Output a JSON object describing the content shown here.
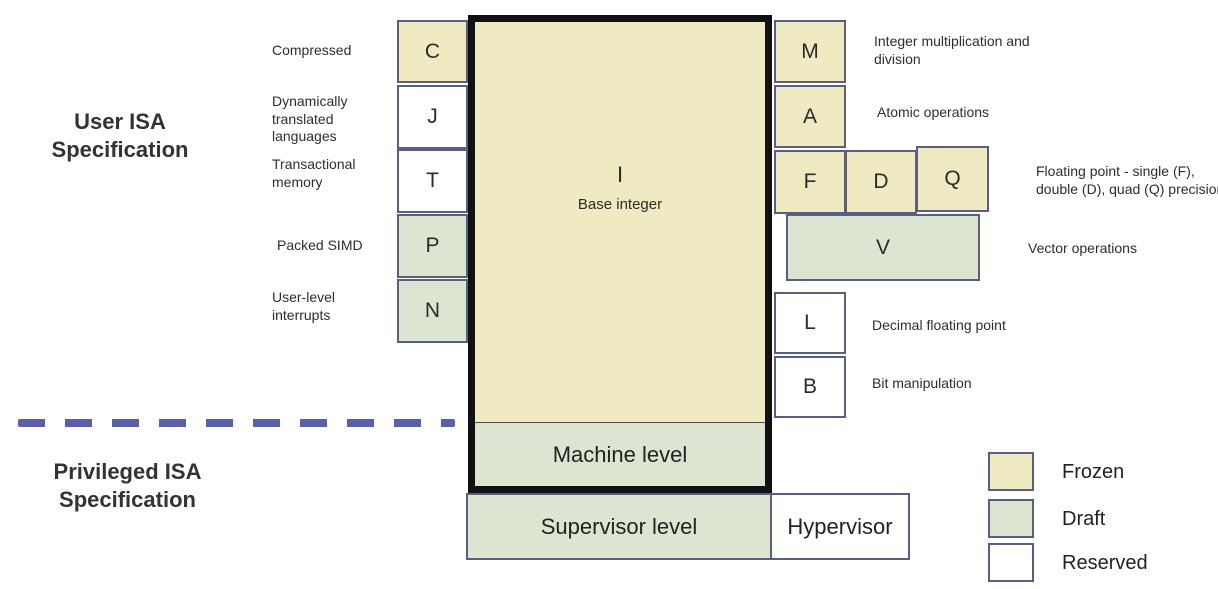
{
  "headings": {
    "user": "User ISA Specification",
    "privileged": "Privileged ISA Specification"
  },
  "base_box": {
    "letter": "I",
    "name": "Base integer",
    "status": "frozen"
  },
  "levels": {
    "machine": {
      "label": "Machine level",
      "status": "draft"
    },
    "supervisor": {
      "label": "Supervisor level",
      "status": "draft"
    },
    "hypervisor": {
      "label": "Hypervisor",
      "status": "reserved"
    }
  },
  "left_extensions": [
    {
      "letter": "C",
      "status": "frozen",
      "label": "Compressed"
    },
    {
      "letter": "J",
      "status": "reserved",
      "label": "Dynamically translated languages"
    },
    {
      "letter": "T",
      "status": "reserved",
      "label": "Transactional memory"
    },
    {
      "letter": "P",
      "status": "draft",
      "label": "Packed SIMD"
    },
    {
      "letter": "N",
      "status": "draft",
      "label": "User-level interrupts"
    }
  ],
  "right_extensions": [
    {
      "letter": "M",
      "status": "frozen",
      "label": "Integer multiplication and division"
    },
    {
      "letter": "A",
      "status": "frozen",
      "label": "Atomic operations"
    },
    {
      "letter": "F",
      "status": "frozen",
      "label": ""
    },
    {
      "letter": "D",
      "status": "frozen",
      "label": ""
    },
    {
      "letter": "Q",
      "status": "frozen",
      "label": "Floating point - single (F), double (D), quad (Q) precision"
    },
    {
      "letter": "V",
      "status": "draft",
      "label": "Vector operations"
    },
    {
      "letter": "L",
      "status": "reserved",
      "label": "Decimal floating point"
    },
    {
      "letter": "B",
      "status": "reserved",
      "label": "Bit manipulation"
    }
  ],
  "legend": [
    {
      "label": "Frozen",
      "status": "frozen"
    },
    {
      "label": "Draft",
      "status": "draft"
    },
    {
      "label": "Reserved",
      "status": "reserved"
    }
  ],
  "colors": {
    "frozen": "#F0EAC2",
    "draft": "#DCE5D2",
    "reserved": "#FFFFFF",
    "border": "#5A5F7E",
    "frame": "#111111",
    "divider": "#5C5FA9"
  }
}
